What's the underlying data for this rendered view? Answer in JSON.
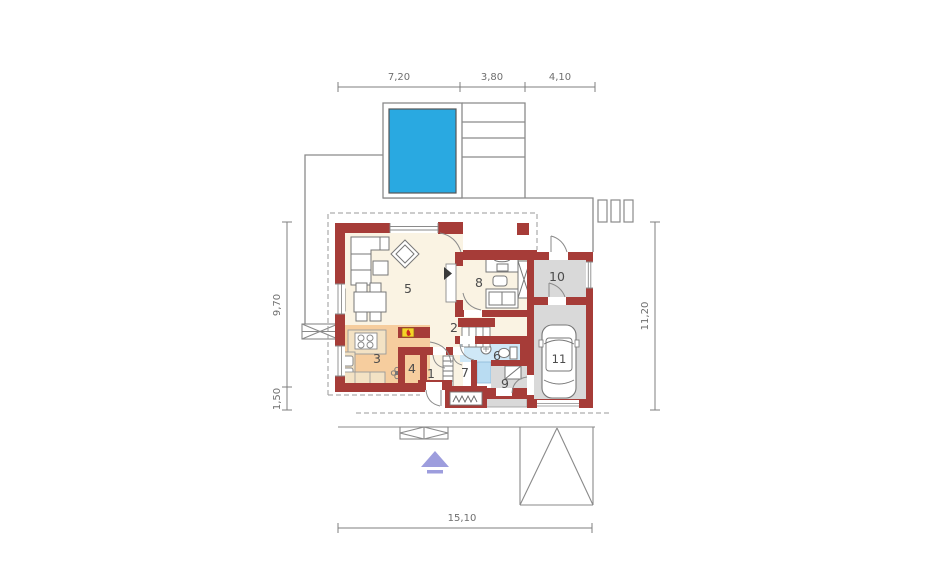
{
  "plan": {
    "type": "house-ground-floor-plan",
    "dimensions": {
      "top": [
        "7,20",
        "3,80",
        "4,10"
      ],
      "left": [
        "9,70",
        "1,50"
      ],
      "right": [
        "11,20"
      ],
      "bottom": [
        "15,10"
      ]
    },
    "rooms": [
      {
        "number": "1"
      },
      {
        "number": "2"
      },
      {
        "number": "3"
      },
      {
        "number": "4"
      },
      {
        "number": "5"
      },
      {
        "number": "6"
      },
      {
        "number": "7"
      },
      {
        "number": "8"
      },
      {
        "number": "9"
      },
      {
        "number": "10"
      },
      {
        "number": "11"
      }
    ],
    "colors": {
      "wall": "#a63c38",
      "pool": "#29a9e1",
      "living_floor": "#faf3e3",
      "kitchen_floor": "#f6cd9e",
      "counter": "#f3e2c4",
      "garage_floor": "#d9d9d9",
      "bathroom_floor": "#cfe8f7",
      "shower": "#b9dcf2",
      "fireplace_insert": "#f5d327",
      "entrance_arrow": "#9d9ddd",
      "outline": "#8a8a8a"
    }
  }
}
